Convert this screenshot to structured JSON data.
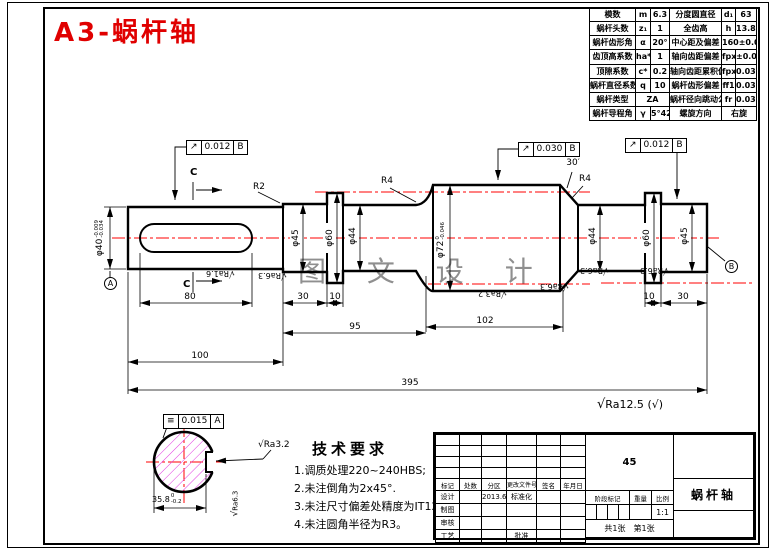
{
  "title": "A3-蜗杆轴",
  "watermark": "图 文 设 计",
  "icons": {
    "roughness": "√",
    "runout": "↗",
    "symmetry": "≡",
    "other_rough": "(√)"
  },
  "datums": {
    "a": "A",
    "b": "B"
  },
  "param_table": {
    "rows": [
      [
        "模数",
        "m",
        "6.3",
        "分度圆直径",
        "d₁",
        "63"
      ],
      [
        "蜗杆头数",
        "z₁",
        "1",
        "全齿高",
        "h",
        "13.86"
      ],
      [
        "蜗杆齿形角",
        "α",
        "20°",
        "中心距及偏差",
        "160±0.05"
      ],
      [
        "齿顶高系数",
        "ha*",
        "1",
        "轴向齿距偏差",
        "fpx",
        "±0.028"
      ],
      [
        "顶隙系数",
        "c*",
        "0.2",
        "轴向齿距累积偏差",
        "fpxl",
        "0.034"
      ],
      [
        "蜗杆直径系数",
        "q",
        "10",
        "蜗杆齿形偏差",
        "ff1",
        "0.032"
      ],
      [
        "蜗杆类型",
        "ZA",
        "蜗杆径向跳动公差",
        "fr",
        "0.035"
      ],
      [
        "蜗杆导程角",
        "γ",
        "5°42′",
        "螺旋方向",
        "右旋"
      ]
    ]
  },
  "drawing": {
    "cut_label": "C",
    "dims": {
      "d80": "80",
      "d30l": "30",
      "d10l": "10",
      "d95": "95",
      "d102": "102",
      "d100": "100",
      "d395": "395",
      "d10r": "10",
      "d30r": "30"
    },
    "dias": {
      "d40": {
        "main": "φ40",
        "sup": "-0.009",
        "sub": "-0.034"
      },
      "d45l": "φ45",
      "d60l": "φ60",
      "d44l": "φ44",
      "d72": {
        "main": "φ72",
        "sup": "0",
        "sub": "-0.046"
      },
      "d44r": "φ44",
      "d60r": "φ60",
      "d45r": "φ45"
    },
    "fillets": {
      "r2": "R2",
      "r4l": "R4",
      "r4r": "R4",
      "angle": "30′"
    },
    "rough": {
      "ra16": "Ra1.6",
      "ra63": "Ra6.3",
      "ra32": "Ra3.2"
    },
    "frames": {
      "f1": {
        "value": "0.012",
        "datum": "B"
      },
      "f2": {
        "value": "0.030",
        "datum": "B"
      },
      "f3": {
        "value": "0.012",
        "datum": "B"
      }
    }
  },
  "section": {
    "frame": {
      "value": "0.015",
      "datum": "A"
    },
    "rough": "Ra3.2",
    "side_rough": "Ra6.3",
    "dim": {
      "main": "35.8",
      "sup": "0",
      "sub": "-0.2"
    }
  },
  "notes": {
    "general_rough": "Ra12.5",
    "other": "(√)"
  },
  "tech_req": {
    "title": "技术要求",
    "items": [
      "1.调质处理220~240HBS;",
      "2.未注倒角为2x45°.",
      "3.未注尺寸偏差处精度为IT12;",
      "4.未注圆角半径为R3。"
    ]
  },
  "title_block": {
    "header": [
      "标记",
      "处数",
      "分区",
      "更改文件号",
      "签名",
      "年月日"
    ],
    "rows": [
      "设计",
      "制图",
      "审核",
      "工艺"
    ],
    "design_date": "2013.6",
    "standardization": "标准化",
    "approval": "批准",
    "material": "45",
    "stage_label": "阶段标记",
    "weight_label": "重量",
    "scale_label": "比例",
    "scale_value": "1:1",
    "sheet_total": "共1张",
    "sheet_no": "第1张",
    "part_name": "蜗杆轴"
  }
}
